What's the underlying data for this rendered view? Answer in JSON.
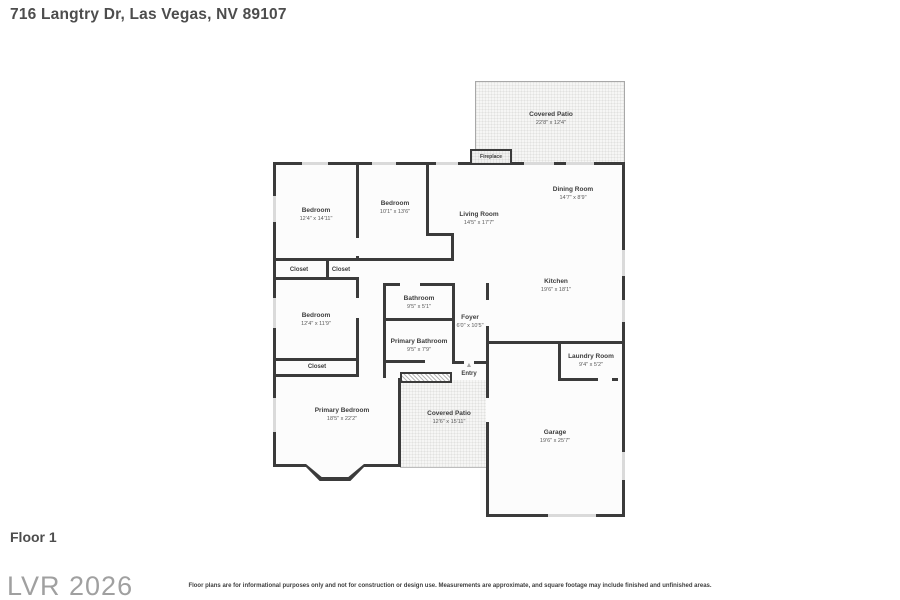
{
  "header": {
    "title": "716 Langtry Dr, Las Vegas, NV 89107"
  },
  "rooms": {
    "covered_patio_top": {
      "name": "Covered Patio",
      "dims": "22'8\" x 12'4\""
    },
    "fireplace": {
      "name": "Fireplace"
    },
    "bedroom_top_left": {
      "name": "Bedroom",
      "dims": "12'4\" x 14'11\""
    },
    "bedroom_top_middle": {
      "name": "Bedroom",
      "dims": "10'1\" x 13'6\""
    },
    "living_room": {
      "name": "Living Room",
      "dims": "14'5\" x 17'7\""
    },
    "dining_room": {
      "name": "Dining Room",
      "dims": "14'7\" x 8'9\""
    },
    "kitchen": {
      "name": "Kitchen",
      "dims": "19'6\" x 18'1\""
    },
    "closet_left": {
      "name": "Closet"
    },
    "closet_right": {
      "name": "Closet"
    },
    "bedroom_middle_left": {
      "name": "Bedroom",
      "dims": "12'4\" x 11'9\""
    },
    "closet_bottom": {
      "name": "Closet"
    },
    "bathroom": {
      "name": "Bathroom",
      "dims": "9'5\" x 5'1\""
    },
    "primary_bathroom": {
      "name": "Primary Bathroom",
      "dims": "9'5\" x 7'9\""
    },
    "foyer": {
      "name": "Foyer",
      "dims": "6'0\" x 10'5\""
    },
    "entry": {
      "name": "Entry"
    },
    "laundry_room": {
      "name": "Laundry Room",
      "dims": "9'4\" x 5'2\""
    },
    "garage": {
      "name": "Garage",
      "dims": "19'6\" x 25'7\""
    },
    "primary_bedroom": {
      "name": "Primary Bedroom",
      "dims": "18'5\" x 22'2\""
    },
    "covered_patio_bottom": {
      "name": "Covered Patio",
      "dims": "12'6\" x 15'11\""
    }
  },
  "icons": {
    "entry_arrow": "▲"
  },
  "colors": {
    "wall": "#3b3b3b",
    "window": "#dadada",
    "patio_bg": "#f6f6f5",
    "text": "#3f3f3f",
    "watermark": "#a0a0a0"
  },
  "footer": {
    "floor_label": "Floor 1",
    "watermark": "LVR 2026",
    "disclaimer": "Floor plans are for informational purposes only and not for construction or design use. Measurements are approximate, and square footage may include finished and unfinished areas."
  }
}
